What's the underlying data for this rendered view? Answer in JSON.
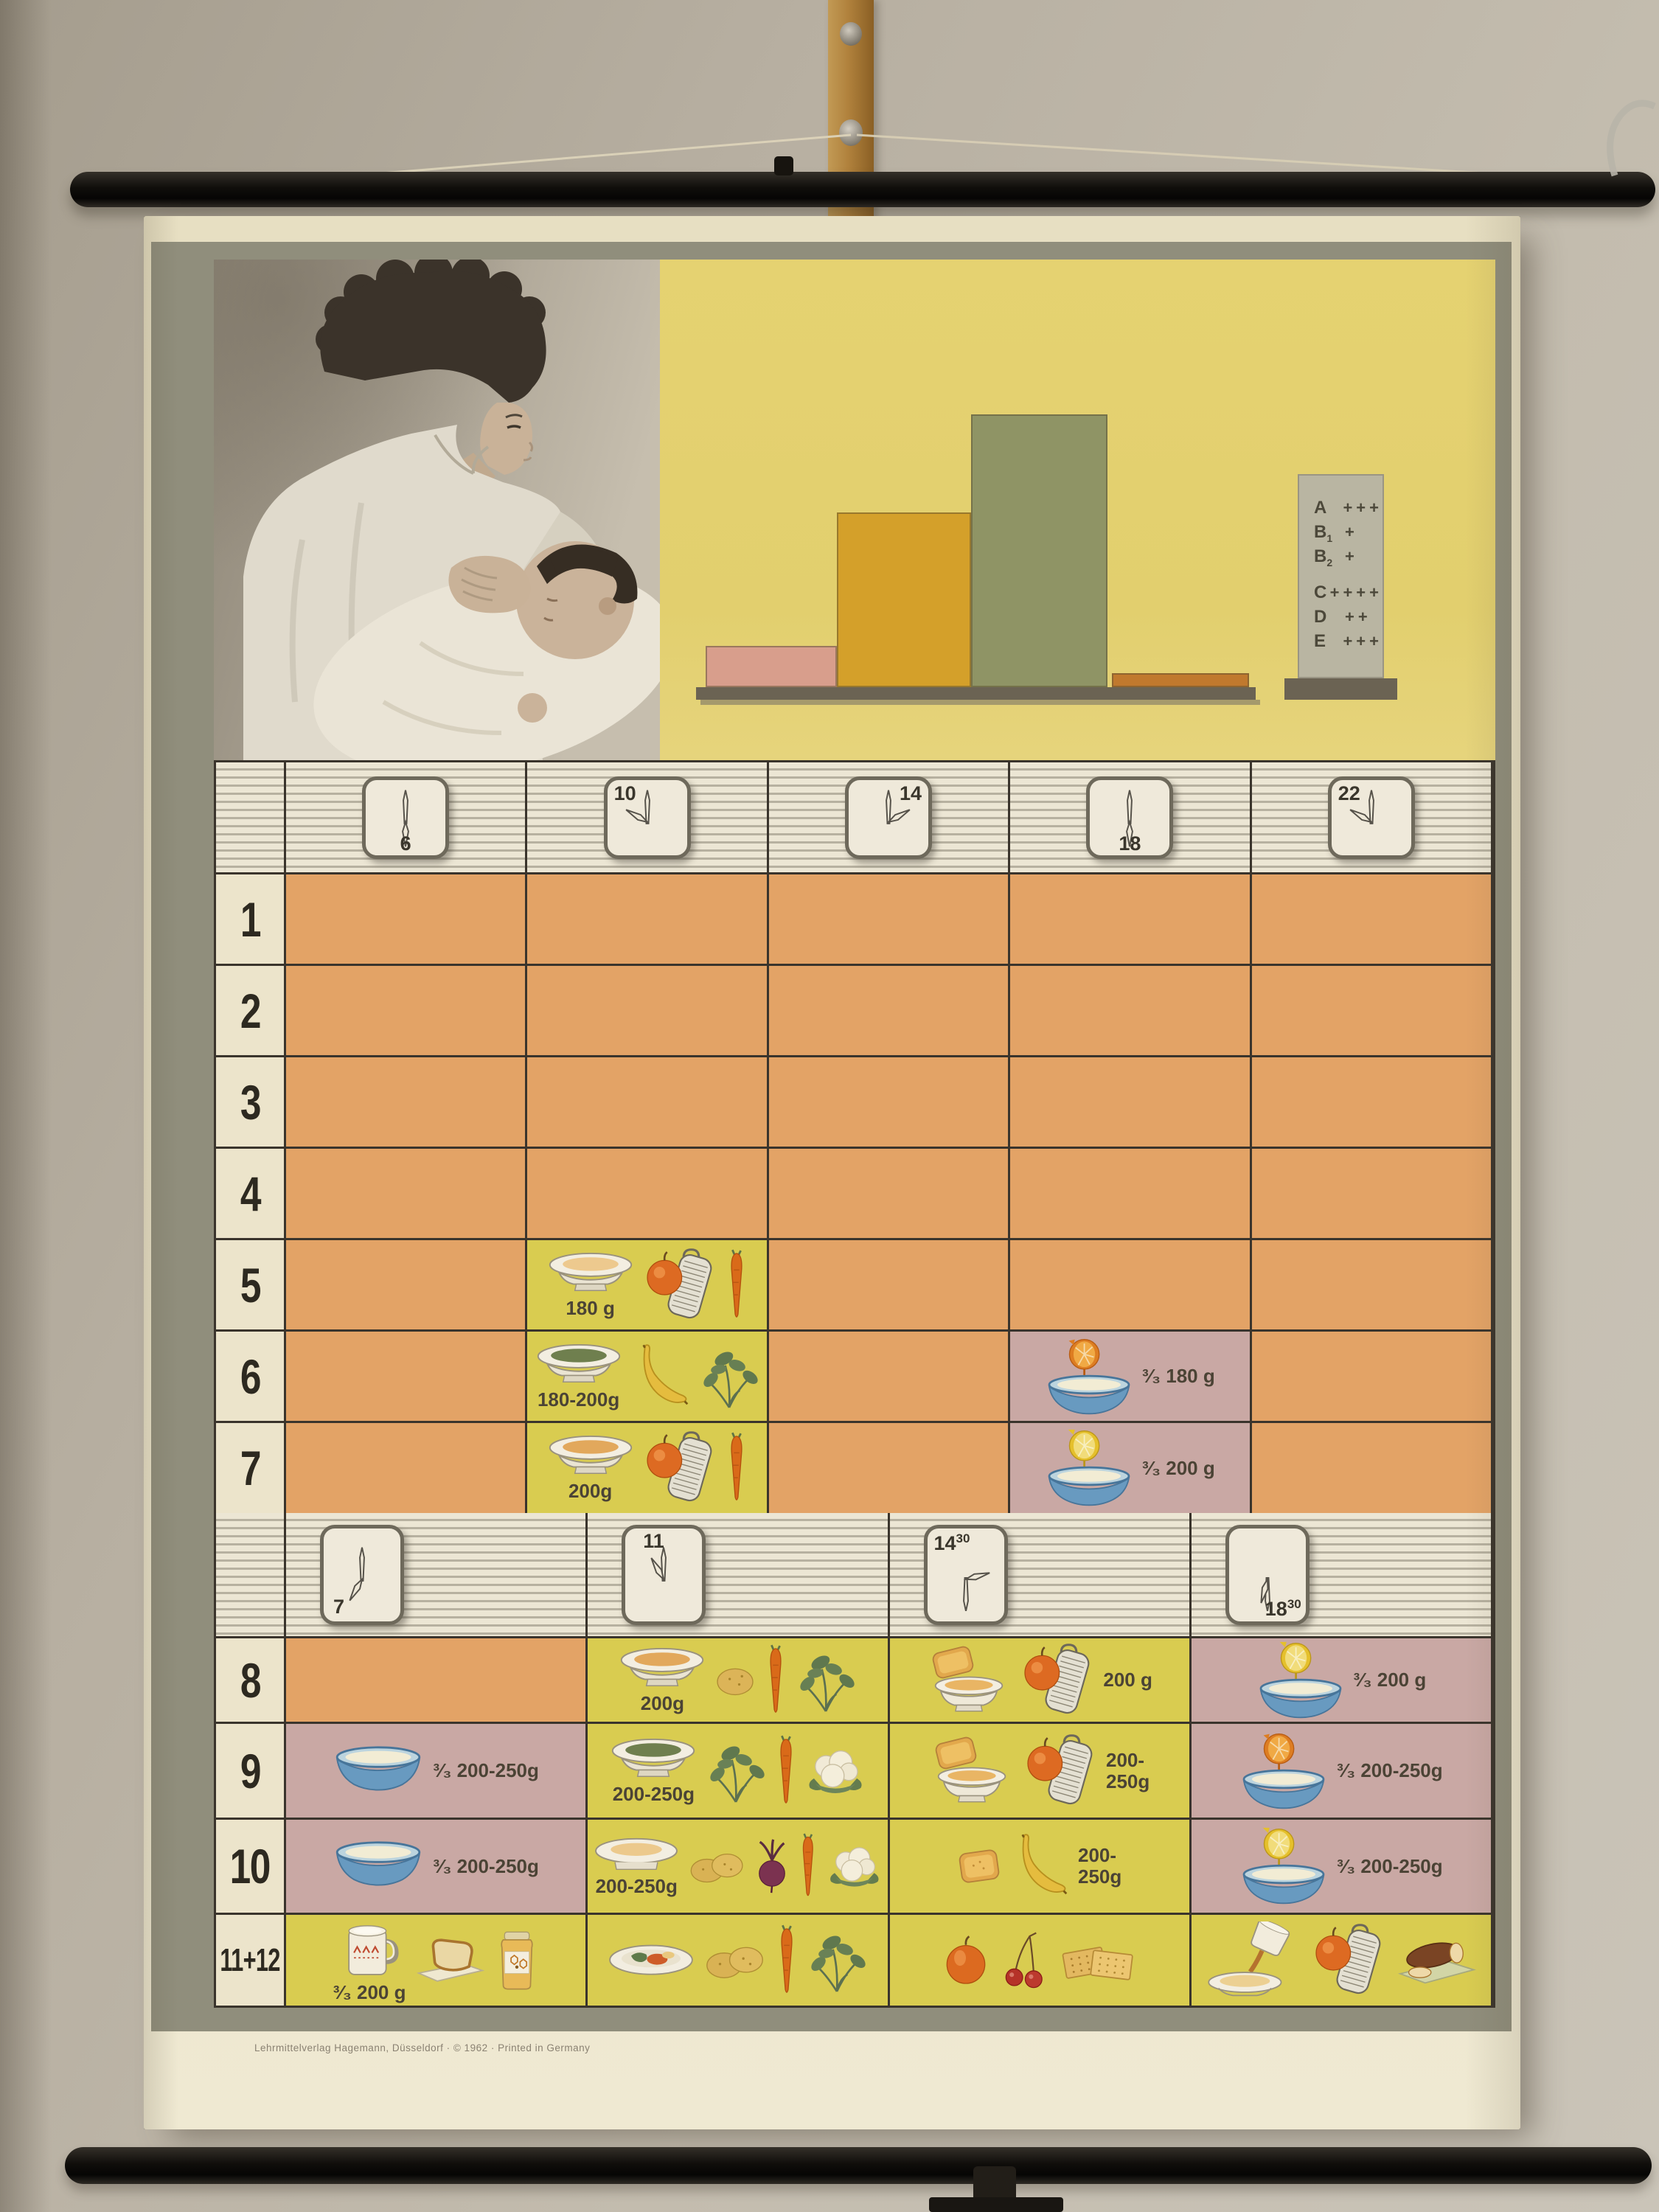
{
  "chart_data": {
    "type": "bar",
    "title": "",
    "categories": [
      "bar-1",
      "bar-2",
      "bar-3",
      "bar-4"
    ],
    "values": [
      15,
      64,
      100,
      5
    ],
    "value_unit": "percent of tallest bar (bars are unlabeled in the print)",
    "colors": [
      "#d89e8c",
      "#d4a02a",
      "#8f9465",
      "#c0792e"
    ],
    "xlabel": "",
    "ylabel": "",
    "vitamins": [
      {
        "label": "A",
        "sub": "",
        "plus": "+++"
      },
      {
        "label": "B",
        "sub": "1",
        "plus": "+"
      },
      {
        "label": "B",
        "sub": "2",
        "plus": "+"
      },
      {
        "label": "C",
        "sub": "",
        "plus": "++++"
      },
      {
        "label": "D",
        "sub": "",
        "plus": "++"
      },
      {
        "label": "E",
        "sub": "",
        "plus": "+++"
      }
    ]
  },
  "poster": {
    "fine_print": "Lehrmittelverlag Hagemann, Düsseldorf · © 1962 · Printed in Germany",
    "schedule_morning": {
      "clocks": [
        {
          "time": "6",
          "sup": "",
          "hour": 180,
          "minute": 0,
          "pos": "b"
        },
        {
          "time": "10",
          "sup": "",
          "hour": 300,
          "minute": 0,
          "pos": "tl"
        },
        {
          "time": "14",
          "sup": "",
          "hour": 60,
          "minute": 0,
          "pos": "tr"
        },
        {
          "time": "18",
          "sup": "",
          "hour": 180,
          "minute": 0,
          "pos": "b"
        },
        {
          "time": "22",
          "sup": "",
          "hour": 300,
          "minute": 0,
          "pos": "tl"
        }
      ],
      "rows": [
        {
          "label": "1",
          "cells": [
            {
              "bg": "orange"
            },
            {
              "bg": "orange"
            },
            {
              "bg": "orange"
            },
            {
              "bg": "orange"
            },
            {
              "bg": "orange"
            }
          ]
        },
        {
          "label": "2",
          "cells": [
            {
              "bg": "orange"
            },
            {
              "bg": "orange"
            },
            {
              "bg": "orange"
            },
            {
              "bg": "orange"
            },
            {
              "bg": "orange"
            }
          ]
        },
        {
          "label": "3",
          "cells": [
            {
              "bg": "orange"
            },
            {
              "bg": "orange"
            },
            {
              "bg": "orange"
            },
            {
              "bg": "orange"
            },
            {
              "bg": "orange"
            }
          ]
        },
        {
          "label": "4",
          "cells": [
            {
              "bg": "orange"
            },
            {
              "bg": "orange"
            },
            {
              "bg": "orange"
            },
            {
              "bg": "orange"
            },
            {
              "bg": "orange"
            }
          ]
        },
        {
          "label": "5",
          "cells": [
            {
              "bg": "orange"
            },
            {
              "bg": "yellow",
              "amount": "180 g",
              "amount_pos": "under",
              "items": [
                "soup-plate-cream",
                "apple-grater",
                "carrot"
              ]
            },
            {
              "bg": "orange"
            },
            {
              "bg": "orange"
            },
            {
              "bg": "orange"
            }
          ]
        },
        {
          "label": "6",
          "cells": [
            {
              "bg": "orange"
            },
            {
              "bg": "yellow",
              "amount": "180-200g",
              "amount_pos": "under",
              "items": [
                "soup-plate-green",
                "banana",
                "spinach"
              ]
            },
            {
              "bg": "orange"
            },
            {
              "bg": "pink",
              "amount": "³⁄₃  180 g",
              "amount_pos": "right",
              "items": [
                "orange-over-bowl"
              ]
            },
            {
              "bg": "orange"
            }
          ]
        },
        {
          "label": "7",
          "cells": [
            {
              "bg": "orange"
            },
            {
              "bg": "yellow",
              "amount": "200g",
              "amount_pos": "under",
              "items": [
                "soup-plate-amber",
                "apple-grater",
                "carrot"
              ]
            },
            {
              "bg": "orange"
            },
            {
              "bg": "pink",
              "amount": "³⁄₃  200 g",
              "amount_pos": "right",
              "items": [
                "lemon-over-bowl"
              ]
            },
            {
              "bg": "orange"
            }
          ]
        }
      ]
    },
    "schedule_later": {
      "clocks": [
        {
          "time": "7",
          "sup": "",
          "hour": 210,
          "minute": 0,
          "pos": "bl"
        },
        {
          "time": "11",
          "sup": "",
          "hour": 330,
          "minute": 0,
          "pos": "t"
        },
        {
          "time": "14",
          "sup": "30",
          "hour": 75,
          "minute": 180,
          "pos": "tl"
        },
        {
          "time": "18",
          "sup": "30",
          "hour": 195,
          "minute": 180,
          "pos": "br"
        }
      ],
      "rows": [
        {
          "label": "8",
          "cells": [
            {
              "bg": "orange"
            },
            {
              "bg": "yellow",
              "amount": "200g",
              "amount_pos": "under",
              "items": [
                "soup-plate-amber",
                "potato",
                "carrot",
                "spinach"
              ]
            },
            {
              "bg": "yellow",
              "amount": "200 g",
              "amount_pos": "right",
              "items": [
                "rusk-bowl",
                "apple-grater"
              ]
            },
            {
              "bg": "pink",
              "amount": "³⁄₃  200 g",
              "amount_pos": "right",
              "items": [
                "lemon-over-bowl"
              ]
            }
          ]
        },
        {
          "label": "9",
          "cells": [
            {
              "bg": "pink",
              "amount": "³⁄₃  200-250g",
              "amount_pos": "right",
              "items": [
                "milk-bowl"
              ]
            },
            {
              "bg": "yellow",
              "amount": "200-250g",
              "amount_pos": "under",
              "items": [
                "soup-plate-green",
                "spinach",
                "carrot",
                "cauliflower"
              ]
            },
            {
              "bg": "yellow",
              "amount": "200-\n250g",
              "amount_pos": "right",
              "items": [
                "rusk-bowl",
                "apple-grater"
              ]
            },
            {
              "bg": "pink",
              "amount": "³⁄₃  200-250g",
              "amount_pos": "right",
              "items": [
                "orange-over-bowl"
              ]
            }
          ]
        },
        {
          "label": "10",
          "cells": [
            {
              "bg": "pink",
              "amount": "³⁄₃  200-250g",
              "amount_pos": "right",
              "items": [
                "milk-bowl"
              ]
            },
            {
              "bg": "yellow",
              "amount": "200-250g",
              "amount_pos": "under",
              "items": [
                "plate-cream",
                "potatoes",
                "beet",
                "carrot",
                "cauliflower"
              ]
            },
            {
              "bg": "yellow",
              "amount": "200-\n250g",
              "amount_pos": "right",
              "items": [
                "rusk",
                "banana"
              ]
            },
            {
              "bg": "pink",
              "amount": "³⁄₃  200-250g",
              "amount_pos": "right",
              "items": [
                "lemon-over-bowl"
              ]
            }
          ]
        },
        {
          "label": "11+12",
          "cells": [
            {
              "bg": "yellow",
              "amount": "³⁄₃ 200 g",
              "amount_pos": "under",
              "items": [
                "mug",
                "bread-slice",
                "jam-jar"
              ]
            },
            {
              "bg": "yellow",
              "items": [
                "dinner-plate",
                "potatoes",
                "carrot",
                "spinach"
              ]
            },
            {
              "bg": "yellow",
              "items": [
                "apple",
                "cherries",
                "crackers"
              ]
            },
            {
              "bg": "yellow",
              "items": [
                "pour-plate",
                "apple-grater",
                "bread-board"
              ]
            }
          ]
        }
      ]
    }
  }
}
